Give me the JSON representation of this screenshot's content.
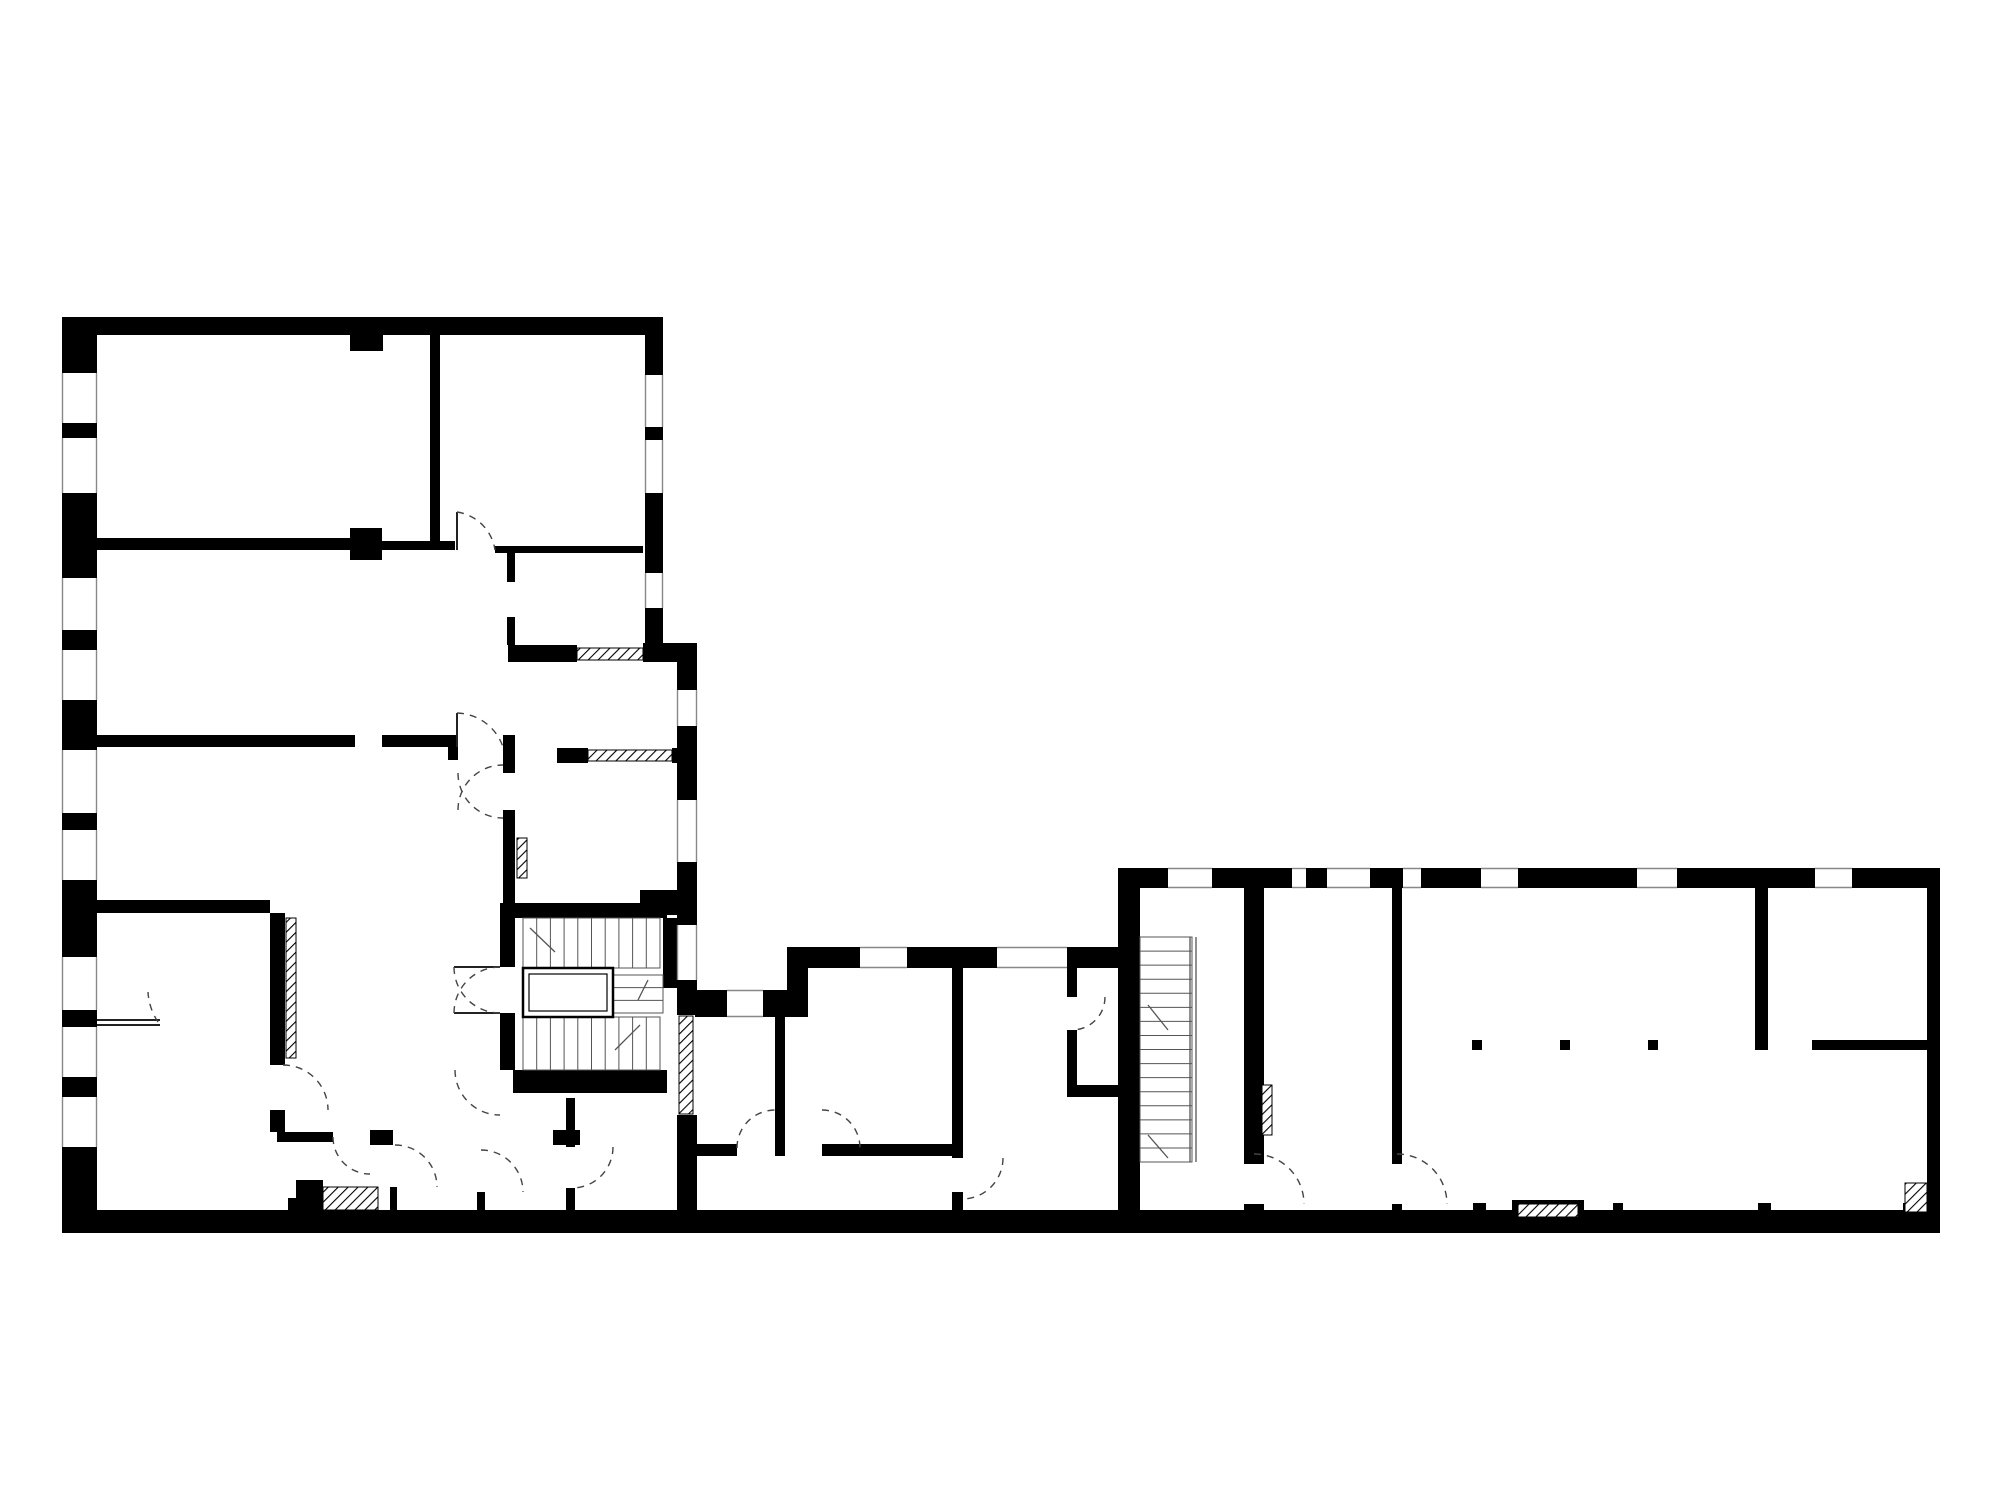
{
  "meta": {
    "type": "architectural-floor-plan",
    "canvas": {
      "width": 2000,
      "height": 1500
    },
    "colors": {
      "background": "#ffffff",
      "wall": "#000000",
      "thin_line": "#888888",
      "stair_line": "#555555",
      "door_arc": "#444444",
      "leaf": "#222222",
      "hatch": "#000000"
    }
  },
  "walls": [
    [
      62,
      317,
      601,
      18
    ],
    [
      350,
      335,
      33,
      16
    ],
    [
      62,
      317,
      35,
      56
    ],
    [
      62,
      423,
      35,
      15
    ],
    [
      62,
      493,
      35,
      85
    ],
    [
      62,
      630,
      35,
      20
    ],
    [
      62,
      700,
      35,
      50
    ],
    [
      62,
      813,
      35,
      17
    ],
    [
      62,
      880,
      35,
      77
    ],
    [
      62,
      1010,
      35,
      17
    ],
    [
      62,
      1077,
      35,
      20
    ],
    [
      62,
      1147,
      35,
      86
    ],
    [
      62,
      1210,
      1878,
      23
    ],
    [
      430,
      335,
      10,
      215
    ],
    [
      97,
      538,
      258,
      12
    ],
    [
      350,
      528,
      32,
      32
    ],
    [
      382,
      541,
      73,
      9
    ],
    [
      495,
      546,
      148,
      7
    ],
    [
      645,
      335,
      18,
      40
    ],
    [
      645,
      427,
      18,
      13
    ],
    [
      645,
      493,
      18,
      80
    ],
    [
      645,
      608,
      18,
      39
    ],
    [
      643,
      643,
      54,
      19
    ],
    [
      508,
      645,
      69,
      17
    ],
    [
      677,
      662,
      20,
      28
    ],
    [
      677,
      726,
      20,
      74
    ],
    [
      677,
      862,
      20,
      63
    ],
    [
      677,
      980,
      20,
      35
    ],
    [
      677,
      1115,
      20,
      97
    ],
    [
      97,
      900,
      173,
      13
    ],
    [
      640,
      890,
      37,
      25
    ],
    [
      270,
      913,
      15,
      152
    ],
    [
      270,
      1110,
      15,
      22
    ],
    [
      97,
      735,
      258,
      12
    ],
    [
      382,
      735,
      66,
      12
    ],
    [
      448,
      735,
      10,
      25
    ],
    [
      503,
      735,
      12,
      38
    ],
    [
      503,
      810,
      12,
      93
    ],
    [
      557,
      748,
      31,
      15
    ],
    [
      672,
      748,
      25,
      15
    ],
    [
      507,
      553,
      8,
      29
    ],
    [
      507,
      617,
      8,
      28
    ],
    [
      500,
      903,
      167,
      15
    ],
    [
      500,
      918,
      15,
      49
    ],
    [
      500,
      1013,
      15,
      57
    ],
    [
      513,
      1070,
      154,
      23
    ],
    [
      663,
      918,
      34,
      70
    ],
    [
      277,
      1132,
      56,
      10
    ],
    [
      370,
      1130,
      23,
      15
    ],
    [
      390,
      1187,
      7,
      25
    ],
    [
      477,
      1192,
      8,
      20
    ],
    [
      553,
      1130,
      27,
      15
    ],
    [
      566,
      1098,
      9,
      49
    ],
    [
      566,
      1188,
      9,
      24
    ],
    [
      296,
      1180,
      27,
      32
    ],
    [
      288,
      1198,
      8,
      14
    ],
    [
      695,
      990,
      32,
      27
    ],
    [
      763,
      990,
      45,
      27
    ],
    [
      787,
      947,
      21,
      43
    ],
    [
      787,
      947,
      73,
      21
    ],
    [
      907,
      947,
      90,
      21
    ],
    [
      1067,
      947,
      56,
      21
    ],
    [
      952,
      968,
      11,
      190
    ],
    [
      952,
      1192,
      11,
      20
    ],
    [
      775,
      1017,
      10,
      133
    ],
    [
      695,
      1144,
      42,
      12
    ],
    [
      775,
      1144,
      10,
      12
    ],
    [
      822,
      1144,
      141,
      12
    ],
    [
      1067,
      968,
      10,
      29
    ],
    [
      1067,
      1030,
      10,
      55
    ],
    [
      1067,
      1085,
      56,
      12
    ],
    [
      1118,
      868,
      50,
      20
    ],
    [
      1212,
      868,
      80,
      20
    ],
    [
      1306,
      868,
      21,
      20
    ],
    [
      1370,
      868,
      33,
      20
    ],
    [
      1421,
      868,
      60,
      20
    ],
    [
      1518,
      868,
      119,
      20
    ],
    [
      1677,
      868,
      138,
      20
    ],
    [
      1852,
      868,
      88,
      20
    ],
    [
      1118,
      888,
      22,
      324
    ],
    [
      1927,
      868,
      13,
      344
    ],
    [
      1244,
      888,
      20,
      276
    ],
    [
      1244,
      1204,
      20,
      8
    ],
    [
      1392,
      888,
      10,
      276
    ],
    [
      1392,
      1204,
      10,
      8
    ],
    [
      1755,
      888,
      13,
      162
    ],
    [
      1812,
      1040,
      115,
      10
    ],
    [
      1472,
      1040,
      10,
      10
    ],
    [
      1560,
      1040,
      10,
      10
    ],
    [
      1648,
      1040,
      10,
      10
    ],
    [
      1473,
      1203,
      13,
      9
    ],
    [
      1613,
      1203,
      10,
      9
    ],
    [
      1758,
      1203,
      13,
      9
    ],
    [
      1903,
      1203,
      11,
      9
    ],
    [
      1512,
      1200,
      72,
      21
    ]
  ],
  "windows": [
    {
      "r": [
        62,
        373,
        35,
        50
      ],
      "o": "v"
    },
    {
      "r": [
        62,
        438,
        35,
        55
      ],
      "o": "v"
    },
    {
      "r": [
        62,
        578,
        35,
        52
      ],
      "o": "v"
    },
    {
      "r": [
        62,
        650,
        35,
        50
      ],
      "o": "v"
    },
    {
      "r": [
        62,
        750,
        35,
        63
      ],
      "o": "v"
    },
    {
      "r": [
        62,
        830,
        35,
        50
      ],
      "o": "v"
    },
    {
      "r": [
        62,
        957,
        35,
        53
      ],
      "o": "v"
    },
    {
      "r": [
        62,
        1027,
        35,
        50
      ],
      "o": "v"
    },
    {
      "r": [
        62,
        1097,
        35,
        50
      ],
      "o": "v"
    },
    {
      "r": [
        645,
        375,
        18,
        52
      ],
      "o": "v"
    },
    {
      "r": [
        645,
        440,
        18,
        53
      ],
      "o": "v"
    },
    {
      "r": [
        645,
        573,
        18,
        35
      ],
      "o": "v"
    },
    {
      "r": [
        677,
        690,
        20,
        36
      ],
      "o": "v"
    },
    {
      "r": [
        677,
        800,
        20,
        62
      ],
      "o": "v"
    },
    {
      "r": [
        677,
        925,
        20,
        55
      ],
      "o": "v"
    },
    {
      "r": [
        727,
        990,
        36,
        27
      ],
      "o": "h"
    },
    {
      "r": [
        860,
        947,
        47,
        21
      ],
      "o": "h"
    },
    {
      "r": [
        997,
        947,
        70,
        21
      ],
      "o": "h"
    },
    {
      "r": [
        1168,
        868,
        44,
        20
      ],
      "o": "h"
    },
    {
      "r": [
        1292,
        868,
        14,
        20
      ],
      "o": "h"
    },
    {
      "r": [
        1327,
        868,
        43,
        20
      ],
      "o": "h"
    },
    {
      "r": [
        1403,
        868,
        18,
        20
      ],
      "o": "h"
    },
    {
      "r": [
        1481,
        868,
        37,
        20
      ],
      "o": "h"
    },
    {
      "r": [
        1637,
        868,
        40,
        20
      ],
      "o": "h"
    },
    {
      "r": [
        1815,
        868,
        37,
        20
      ],
      "o": "h"
    }
  ],
  "white_cuts": [
    [
      577,
      648,
      66,
      12
    ],
    [
      588,
      750,
      84,
      11
    ],
    [
      1518,
      1204,
      60,
      13
    ]
  ],
  "hatches": [
    [
      286,
      918,
      10,
      140
    ],
    [
      517,
      838,
      10,
      40
    ],
    [
      577,
      648,
      66,
      12
    ],
    [
      679,
      1016,
      14,
      98
    ],
    [
      1262,
      1085,
      10,
      50
    ],
    [
      323,
      1187,
      55,
      23
    ],
    [
      1518,
      1204,
      60,
      13
    ],
    [
      1905,
      1183,
      22,
      29
    ],
    [
      588,
      750,
      84,
      11
    ]
  ],
  "stair_flights": [
    {
      "x": 523,
      "y": 918,
      "w": 137,
      "h": 50,
      "dir": "v",
      "n": 10
    },
    {
      "x": 523,
      "y": 1017,
      "w": 137,
      "h": 53,
      "dir": "v",
      "n": 10
    },
    {
      "x": 613,
      "y": 975,
      "w": 50,
      "h": 38,
      "dir": "h",
      "n": 3
    },
    {
      "x": 1140,
      "y": 937,
      "w": 52,
      "h": 225,
      "dir": "h",
      "n": 16
    }
  ],
  "stair_rails": [
    [
      1190,
      937,
      1190,
      1162
    ],
    [
      1196,
      937,
      1196,
      1162
    ]
  ],
  "break_marks": [
    [
      530,
      928,
      555,
      952
    ],
    [
      640,
      1025,
      615,
      1050
    ],
    [
      648,
      980,
      638,
      1000
    ],
    [
      1148,
      1005,
      1168,
      1030
    ],
    [
      1148,
      1135,
      1168,
      1158
    ]
  ],
  "elevator": {
    "outer": [
      523,
      968,
      90,
      49
    ],
    "inner": [
      529,
      974,
      78,
      37
    ]
  },
  "door_leaves": [
    [
      457,
      512,
      457,
      550
    ],
    [
      457,
      713,
      457,
      747
    ],
    [
      454,
      967,
      500,
      967
    ],
    [
      454,
      1013,
      500,
      1013
    ],
    [
      97,
      1020,
      160,
      1020
    ],
    [
      97,
      1025,
      160,
      1025
    ]
  ],
  "door_arcs": [
    {
      "d": "M 457 512 A 45 45 0 0 1 495 550"
    },
    {
      "d": "M 457 713 A 50 50 0 0 1 503 747"
    },
    {
      "d": "M 458 773 A 45 45 0 0 0 503 818"
    },
    {
      "d": "M 458 810 A 45 45 0 0 1 503 765"
    },
    {
      "d": "M 454 967 A 46 46 0 0 0 500 1013"
    },
    {
      "d": "M 454 1013 A 46 46 0 0 1 500 967"
    },
    {
      "d": "M 455 1070 A 45 45 0 0 0 500 1115"
    },
    {
      "d": "M 283 1065 A 45 45 0 0 1 328 1110"
    },
    {
      "d": "M 158 1022 A 60 60 0 0 1 148 992"
    },
    {
      "d": "M 333 1137 A 37 37 0 0 0 370 1174"
    },
    {
      "d": "M 395 1145 A 42 42 0 0 1 437 1187"
    },
    {
      "d": "M 481 1150 A 42 42 0 0 1 523 1192"
    },
    {
      "d": "M 613 1147 A 41 41 0 0 1 572 1188"
    },
    {
      "d": "M 737 1148 A 38 38 0 0 1 775 1110"
    },
    {
      "d": "M 822 1110 A 38 38 0 0 1 860 1148"
    },
    {
      "d": "M 1003 1158 A 41 41 0 0 1 962 1199"
    },
    {
      "d": "M 1105 997 A 33 33 0 0 1 1072 1030"
    },
    {
      "d": "M 1254 1154 A 50 50 0 0 1 1304 1204"
    },
    {
      "d": "M 1397 1154 A 50 50 0 0 1 1447 1204"
    }
  ]
}
